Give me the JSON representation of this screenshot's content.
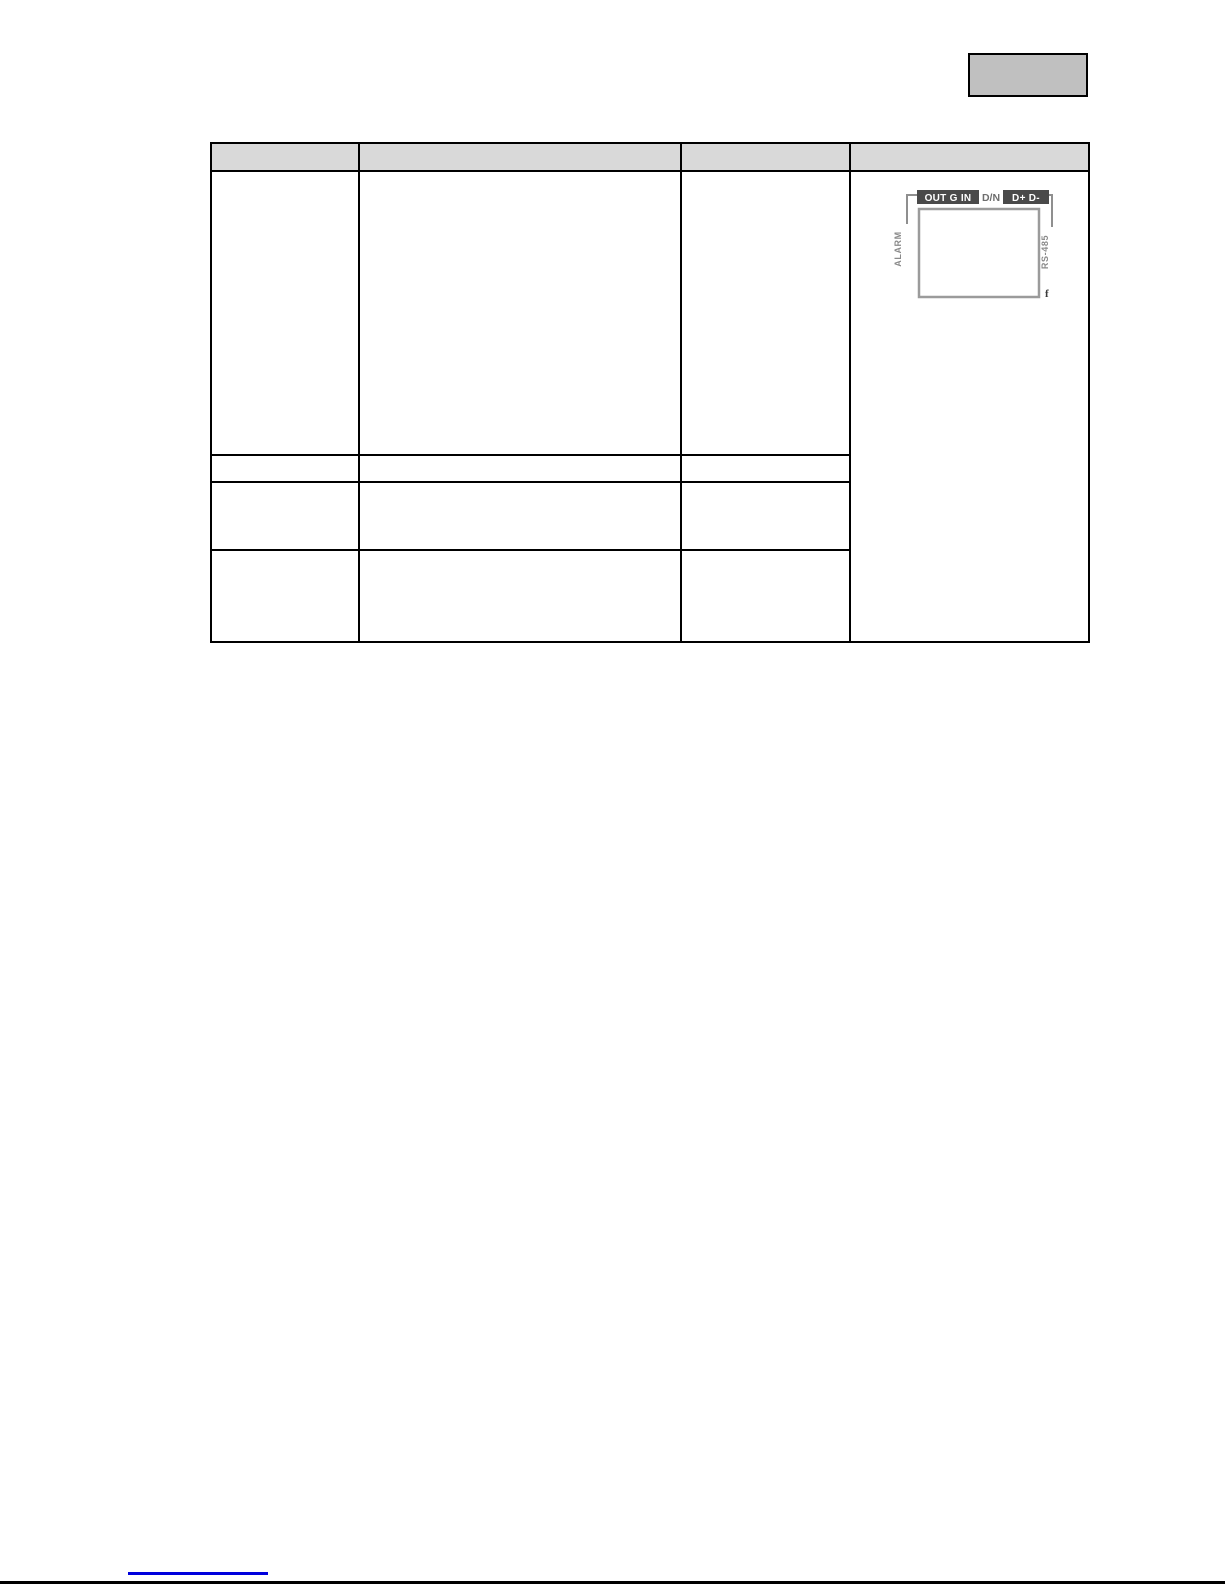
{
  "page": {
    "width": 1225,
    "height": 1585,
    "background": "#ffffff"
  },
  "header_box": {
    "label": ""
  },
  "table": {
    "header": [
      "",
      "",
      "",
      ""
    ],
    "rows": [
      {
        "cells": [
          "",
          "",
          ""
        ]
      },
      {
        "cells": [
          "",
          "",
          ""
        ]
      },
      {
        "cells": [
          "",
          "",
          ""
        ]
      },
      {
        "cells": [
          "",
          "",
          ""
        ]
      }
    ]
  },
  "diagram": {
    "badge_left": "OUT G IN",
    "middle_label": "D/N",
    "badge_right": "D+ D-",
    "left_label": "ALARM",
    "right_label": "RS-485",
    "corner_mark": "f",
    "colors": {
      "badge_bg": "#4a4a4a",
      "badge_text": "#ffffff",
      "line": "#8f8f8f",
      "side_text": "#8a8a8a"
    }
  },
  "footer": {
    "link_text": "",
    "link_color": "#0000dd",
    "rule_color": "#000000"
  },
  "colors": {
    "table_header_bg": "#d9d9d9",
    "table_border": "#000000",
    "header_box_bg": "#c0c0c0"
  }
}
